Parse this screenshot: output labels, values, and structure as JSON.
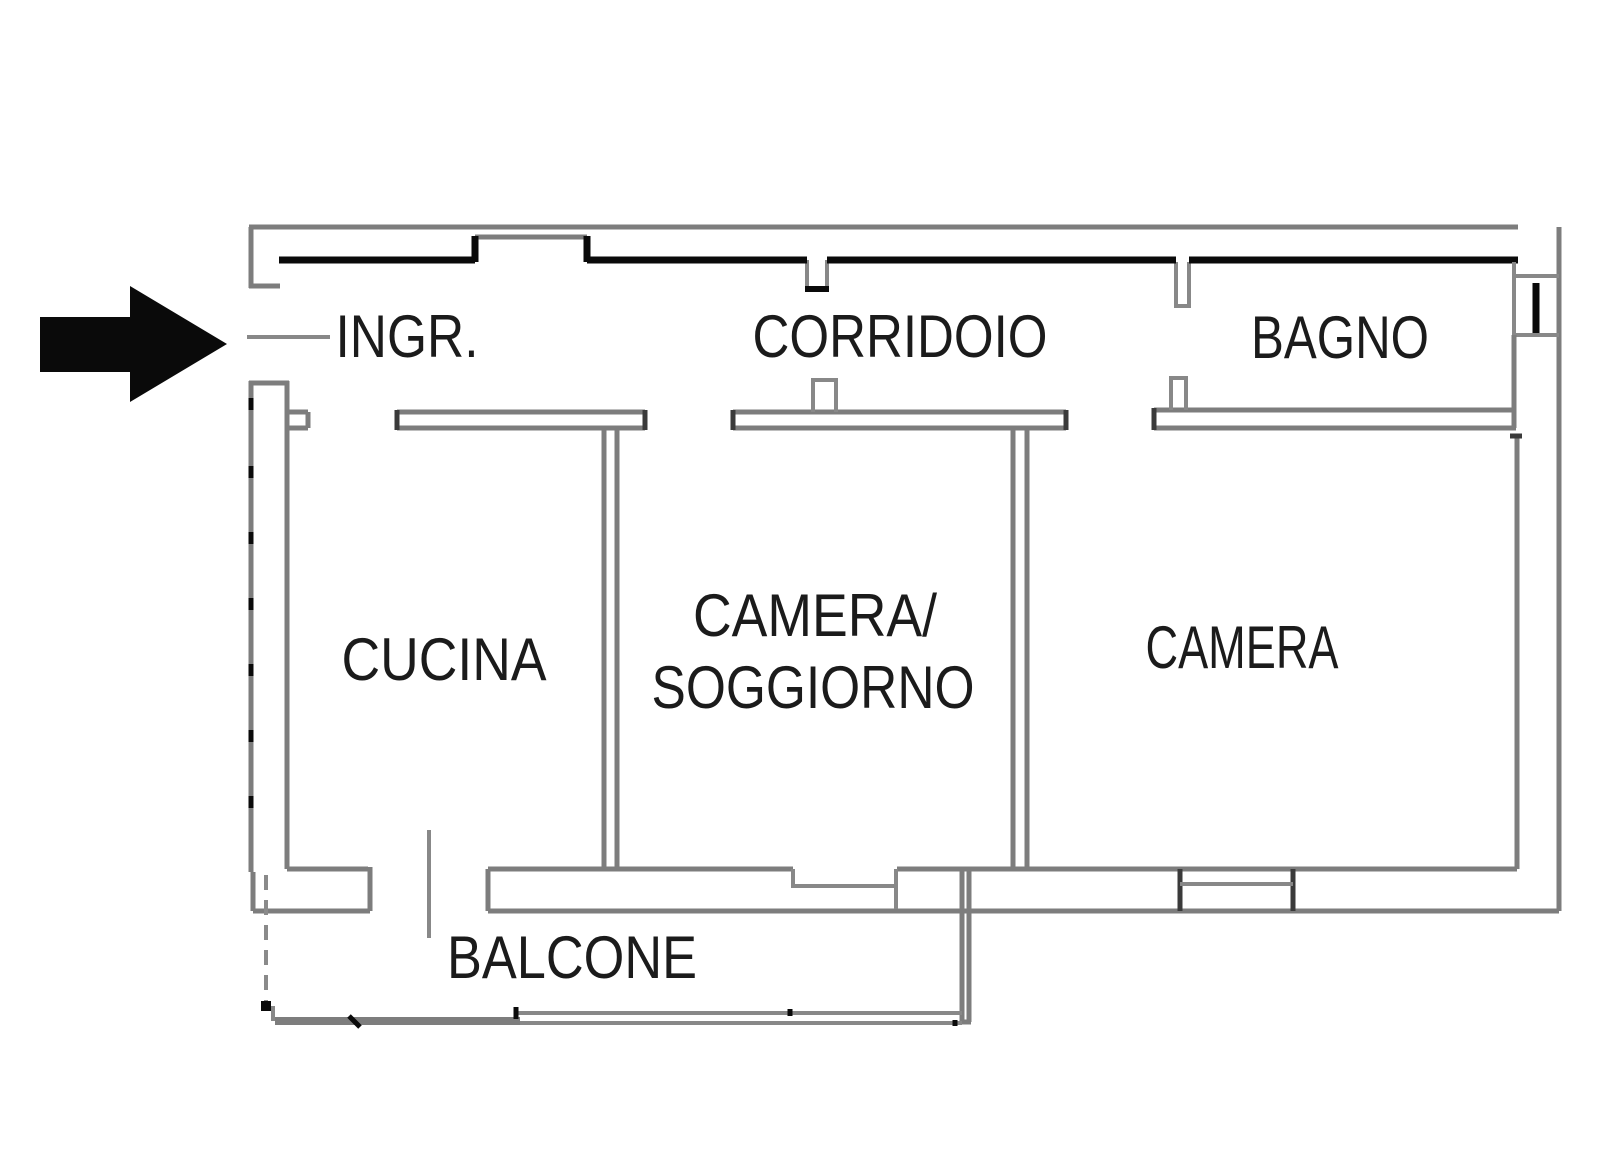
{
  "floor_plan": {
    "type": "apartment-floor-plan",
    "rooms": [
      {
        "id": "ingresso",
        "label": "INGR."
      },
      {
        "id": "corridoio",
        "label": "CORRIDOIO"
      },
      {
        "id": "bagno",
        "label": "BAGNO"
      },
      {
        "id": "cucina",
        "label": "CUCINA"
      },
      {
        "id": "camera_soggiorno",
        "label": "CAMERA/",
        "label2": "SOGGIORNO"
      },
      {
        "id": "camera",
        "label": "CAMERA"
      },
      {
        "id": "balcone",
        "label": "BALCONE"
      }
    ],
    "icons": {
      "entrance_arrow": "right-arrow"
    },
    "colors": {
      "wall": "#7d7d7d",
      "wall_accent": "#3a3a3a",
      "inner_wall": "#0a0a0a",
      "label_text": "#1b1b1b",
      "arrow": "#0a0a0a",
      "background": "#ffffff"
    }
  }
}
